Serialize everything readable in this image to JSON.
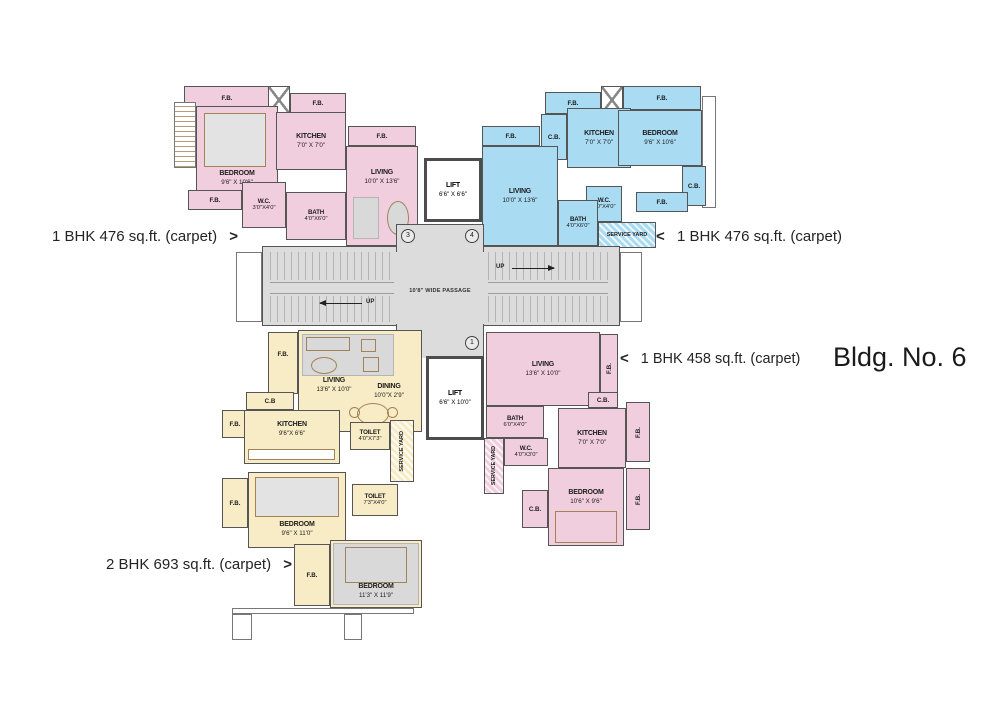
{
  "title": "Bldg. No. 6",
  "colors": {
    "pink": "#f1cede",
    "blue": "#a9dbf2",
    "yellow": "#f8ecc6",
    "gray": "#dcdcdc",
    "wall": "#555555"
  },
  "annotations": {
    "flat3": {
      "arrow": ">",
      "text": "1 BHK 476 sq.ft. (carpet)"
    },
    "flat4": {
      "arrow": "<",
      "text": "1 BHK 476 sq.ft. (carpet)"
    },
    "flat1": {
      "arrow": "<",
      "text": "1 BHK 458 sq.ft. (carpet)"
    },
    "flat2": {
      "arrow": ">",
      "text": "2 BHK 693 sq.ft. (carpet)"
    }
  },
  "common": {
    "passage": "10'8\" WIDE PASSAGE",
    "up": "UP",
    "lift_upper": {
      "name": "LIFT",
      "dims": "6'6\" X 6'6\""
    },
    "lift_lower": {
      "name": "LIFT",
      "dims": "6'6\" X 10'0\""
    },
    "flats": {
      "f1": "1",
      "f2": "2",
      "f3": "3",
      "f4": "4"
    }
  },
  "unit_a": {
    "fb": "F.B.",
    "kitchen": {
      "name": "KITCHEN",
      "dims": "7'0\" X 7'0\""
    },
    "living": {
      "name": "LIVING",
      "dims": "10'0\" X 13'6\""
    },
    "bedroom": {
      "name": "BEDROOM",
      "dims": "9'6\" X 10'6\""
    },
    "wc": {
      "name": "W.C.",
      "dims": "3'0\"X4'0\""
    },
    "bath": {
      "name": "BATH",
      "dims": "4'0\"X6'0\""
    }
  },
  "unit_b": {
    "fb": "F.B.",
    "cb": "C.B.",
    "kitchen": {
      "name": "KITCHEN",
      "dims": "7'0\" X 7'0\""
    },
    "bedroom": {
      "name": "BEDROOM",
      "dims": "9'6\" X 10'6\""
    },
    "living": {
      "name": "LIVING",
      "dims": "10'0\" X 13'6\""
    },
    "bath": {
      "name": "BATH",
      "dims": "4'0\"X6'0\""
    },
    "wc": {
      "name": "W.C.",
      "dims": "3'0\"X4'0\""
    },
    "service_yard": "SERVICE YARD"
  },
  "unit_c": {
    "fb": "F.B.",
    "cb": "C.B",
    "living": {
      "name": "LIVING",
      "dims": "13'6\" X 10'0\""
    },
    "dining": {
      "name": "DINING",
      "dims": "10'0\"X 2'9\""
    },
    "kitchen": {
      "name": "KITCHEN",
      "dims": "9'6\"X 6'6\""
    },
    "toilet_small": {
      "name": "TOILET",
      "dims": "4'0\"X7'3\""
    },
    "toilet_large": {
      "name": "TOILET",
      "dims": "7'3\"X4'0\""
    },
    "service_yard": "SERVICE YARD",
    "bedroom1": {
      "name": "BEDROOM",
      "dims": "9'6\" X 11'0\""
    },
    "bedroom2": {
      "name": "BEDROOM",
      "dims": "11'3\" X 11'9\""
    }
  },
  "unit_d": {
    "fb": "F.B.",
    "cb": "C.B.",
    "living": {
      "name": "LIVING",
      "dims": "13'6\" X 10'0\""
    },
    "kitchen": {
      "name": "KITCHEN",
      "dims": "7'0\" X 7'0\""
    },
    "bath": {
      "name": "BATH",
      "dims": "6'0\"X4'0\""
    },
    "wc": {
      "name": "W.C.",
      "dims": "4'0\"X3'0\""
    },
    "bedroom": {
      "name": "BEDROOM",
      "dims": "10'6\" X 9'6\""
    },
    "service_yard": "SERVICE YARD"
  }
}
